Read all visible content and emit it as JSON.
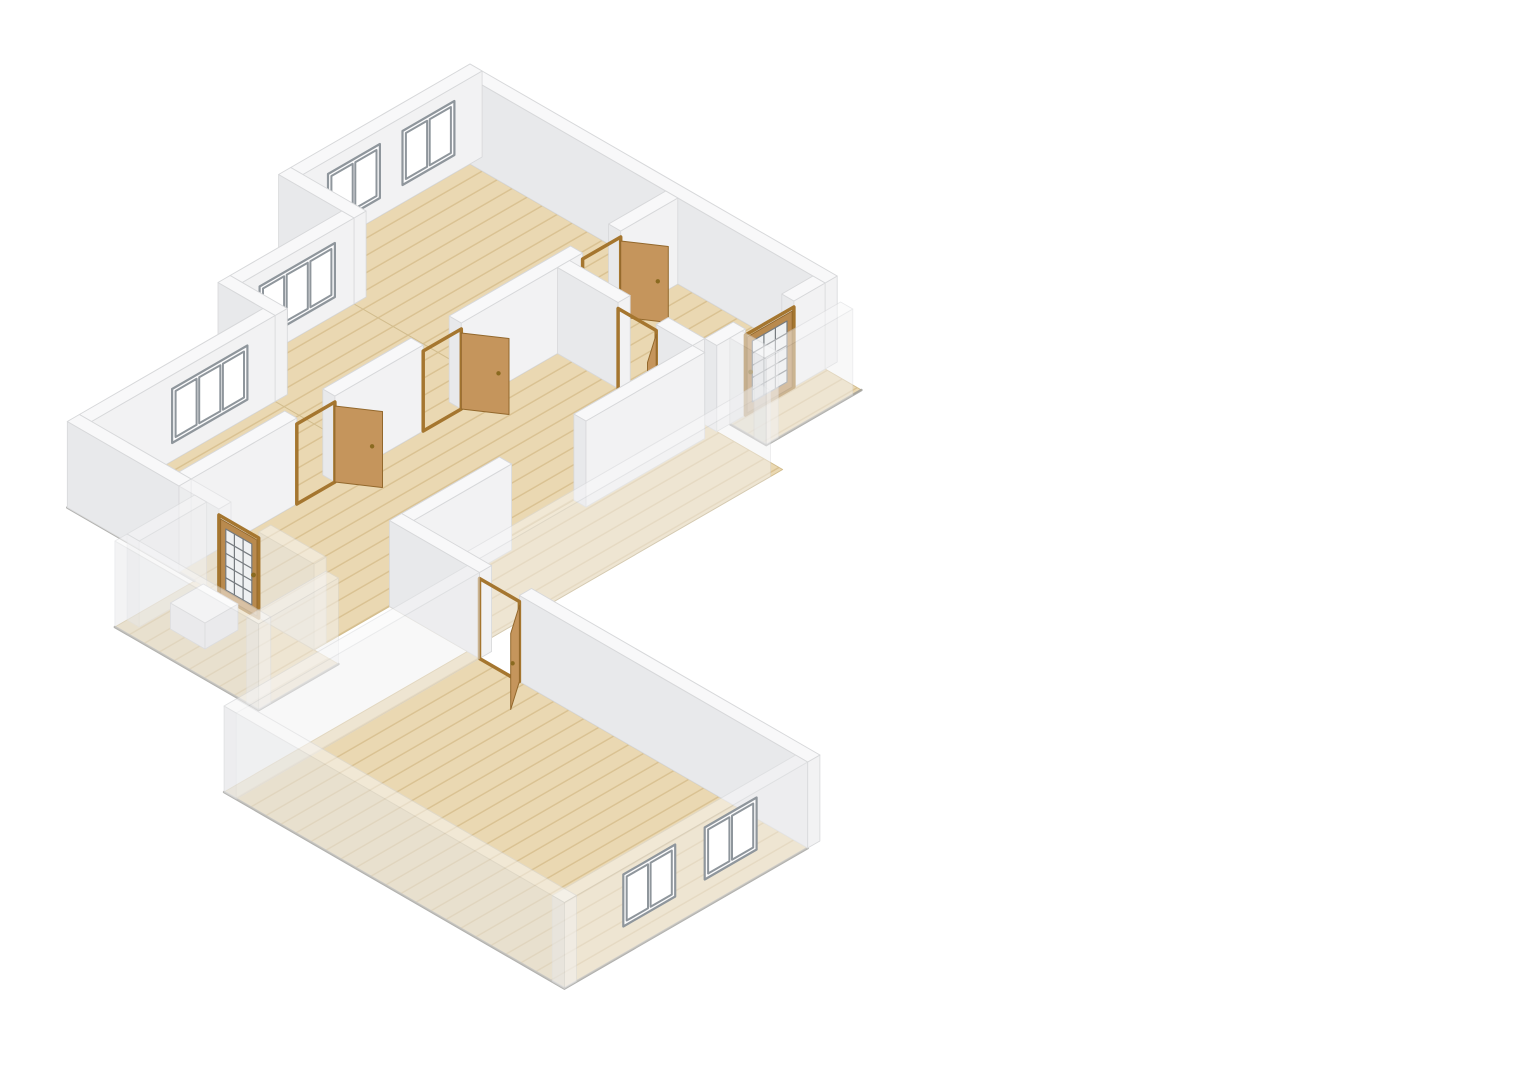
{
  "view": {
    "width": 1529,
    "height": 1080,
    "background": "#ffffff"
  },
  "scene": {
    "iso": {
      "ox": 470,
      "oy": 150,
      "cos": 0.866,
      "sin": 0.5,
      "wallHeight": 86
    },
    "palette": {
      "bg": "#ffffff",
      "wallTop": "#f8f8f9",
      "wallSW": "#e8e9eb",
      "wallSE": "#f2f2f3",
      "wallStroke": "#d7d8da",
      "floorBase": "#ead8b2",
      "floorPlank": "#d9c191",
      "floorStroke": "#d2bd8e",
      "slabEdge": "#9d9d9b",
      "windowFrame": "#fcfcfd",
      "windowBar": "#8f969c",
      "doorFrame": "#a5762f",
      "doorWood": "#c5955c",
      "doorWoodDark": "#93682c",
      "glazedLeaf": "#b98a4e",
      "glass": "#eff1f2",
      "glassBar": "#767b7f",
      "knob": "#8a6a20",
      "fixtureTop": "#ffffff",
      "fixtureSide": "#ededee",
      "fixtureStroke": "#d0d0d2"
    },
    "items": [
      {
        "t": "floor",
        "n": "floor-bedroom-1",
        "r": [
          14,
          14,
          254,
          221
        ]
      },
      {
        "t": "floor",
        "n": "floor-bedroom-2",
        "r": [
          87,
          221,
          254,
          364
        ]
      },
      {
        "t": "floor",
        "n": "floor-bedroom-3",
        "r": [
          139,
          364,
          254,
          590
        ]
      },
      {
        "t": "floor",
        "n": "floor-hallway",
        "r": [
          254,
          14,
          410,
          590
        ]
      },
      {
        "t": "floor",
        "n": "floor-corridor",
        "r": [
          410,
          139,
          500,
          503
        ]
      },
      {
        "t": "floor",
        "n": "floor-rear-porch",
        "r": [
          424,
          14,
          466,
          124
        ]
      },
      {
        "t": "floor",
        "n": "floor-front-porch",
        "r": [
          272,
          590,
          438,
          682
        ]
      },
      {
        "t": "floor",
        "n": "floor-living-room",
        "r": [
          500,
          503,
          893,
          784
        ]
      },
      {
        "t": "edge",
        "n": "slab-edge-left",
        "pts": [
          [
            125,
            590
          ],
          [
            272,
            590
          ]
        ]
      },
      {
        "t": "edge",
        "n": "slab-edge-front-porch",
        "pts": [
          [
            272,
            682
          ],
          [
            438,
            682
          ],
          [
            438,
            590
          ]
        ]
      },
      {
        "t": "edge",
        "n": "slab-edge-rear-porch",
        "pts": [
          [
            424,
            124
          ],
          [
            466,
            124
          ],
          [
            466,
            14
          ]
        ]
      },
      {
        "t": "edge",
        "n": "slab-edge-living-room",
        "pts": [
          [
            500,
            784
          ],
          [
            893,
            784
          ],
          [
            893,
            503
          ]
        ]
      },
      {
        "t": "wall",
        "n": "wall-ne-exterior",
        "r": [
          0,
          0,
          424,
          14
        ]
      },
      {
        "t": "wall",
        "n": "wall-nw-bedroom-1",
        "r": [
          0,
          0,
          14,
          207
        ]
      },
      {
        "t": "win",
        "n": "window-bedroom-1-a",
        "p": "x",
        "c": 14,
        "a": 32,
        "b": 92,
        "z": [
          18,
          72
        ],
        "panes": 2
      },
      {
        "t": "win",
        "n": "window-bedroom-1-b",
        "p": "x",
        "c": 14,
        "a": 118,
        "b": 178,
        "z": [
          18,
          72
        ],
        "panes": 2
      },
      {
        "t": "wall",
        "n": "wall-step-1",
        "r": [
          0,
          207,
          87,
          221
        ]
      },
      {
        "t": "wall",
        "n": "wall-nw-bedroom-2",
        "r": [
          73,
          221,
          87,
          350
        ]
      },
      {
        "t": "win",
        "n": "window-bedroom-2",
        "p": "x",
        "c": 87,
        "a": 243,
        "b": 330,
        "z": [
          18,
          72
        ],
        "panes": 3
      },
      {
        "t": "wall",
        "n": "wall-step-2",
        "r": [
          73,
          350,
          139,
          364
        ]
      },
      {
        "t": "wall",
        "n": "wall-nw-bedroom-3",
        "r": [
          125,
          364,
          139,
          576
        ]
      },
      {
        "t": "win",
        "n": "window-bedroom-3",
        "p": "x",
        "c": 139,
        "a": 396,
        "b": 483,
        "z": [
          18,
          72
        ],
        "panes": 3
      },
      {
        "t": "wall",
        "n": "wall-partition-a",
        "r": [
          240,
          14,
          254,
          80
        ]
      },
      {
        "t": "wall",
        "n": "wall-partition-b",
        "r": [
          240,
          124,
          254,
          264
        ]
      },
      {
        "t": "wall",
        "n": "wall-partition-c",
        "r": [
          240,
          308,
          254,
          410
        ]
      },
      {
        "t": "wall",
        "n": "wall-partition-d",
        "r": [
          240,
          454,
          254,
          576
        ]
      },
      {
        "t": "door",
        "n": "door-bedroom-1",
        "p": "x",
        "c": 254,
        "a": 80,
        "b": 124,
        "leaf": [
          254,
          80,
          287,
          58
        ]
      },
      {
        "t": "door",
        "n": "door-bedroom-2",
        "p": "x",
        "c": 254,
        "a": 264,
        "b": 308,
        "leaf": [
          254,
          264,
          287,
          242
        ]
      },
      {
        "t": "door",
        "n": "door-bedroom-3",
        "p": "x",
        "c": 254,
        "a": 410,
        "b": 454,
        "leaf": [
          254,
          410,
          287,
          388
        ]
      },
      {
        "t": "wall",
        "n": "wall-study-sw-a",
        "r": [
          254,
          139,
          324,
          153
        ]
      },
      {
        "t": "wall",
        "n": "wall-study-sw-b",
        "r": [
          368,
          139,
          410,
          153
        ]
      },
      {
        "t": "door",
        "n": "door-study",
        "p": "y",
        "c": 153,
        "a": 324,
        "b": 368,
        "leaf": [
          368,
          153,
          391,
          186
        ]
      },
      {
        "t": "wall",
        "n": "wall-rear-entry-a",
        "r": [
          410,
          14,
          424,
          50
        ]
      },
      {
        "t": "wall",
        "n": "wall-rear-entry-b",
        "r": [
          410,
          106,
          424,
          139
        ]
      },
      {
        "t": "door",
        "n": "entry-door-rear",
        "p": "x",
        "c": 424,
        "a": 50,
        "b": 106,
        "glazed": true
      },
      {
        "t": "wall",
        "n": "wall-corridor-a",
        "r": [
          410,
          153,
          424,
          290
        ]
      },
      {
        "t": "wall",
        "n": "wall-corridor-b",
        "r": [
          410,
          376,
          424,
          489
        ]
      },
      {
        "t": "wall",
        "n": "wall-corridor-e",
        "r": [
          486,
          153,
          500,
          489
        ],
        "o": 0.5
      },
      {
        "t": "wall",
        "n": "wall-rear-porch-front",
        "r": [
          424,
          110,
          466,
          124
        ],
        "o": 0.5
      },
      {
        "t": "wall",
        "n": "wall-rear-porch-side",
        "r": [
          452,
          24,
          466,
          124
        ],
        "o": 0.5
      },
      {
        "t": "wall",
        "n": "wall-sw-end",
        "r": [
          125,
          576,
          254,
          590
        ]
      },
      {
        "t": "wall",
        "n": "wall-front-a",
        "r": [
          254,
          576,
          300,
          590
        ],
        "o": 0.5
      },
      {
        "t": "wall",
        "n": "wall-front-b",
        "r": [
          346,
          576,
          410,
          590
        ],
        "o": 0.5
      },
      {
        "t": "door",
        "n": "entry-door-front",
        "p": "y",
        "c": 590,
        "a": 300,
        "b": 346,
        "glazed": true
      },
      {
        "t": "wall",
        "n": "wall-front-porch-left",
        "r": [
          272,
          590,
          286,
          668
        ],
        "o": 0.5
      },
      {
        "t": "box",
        "n": "porch-fixture",
        "r": [
          306,
          614,
          346,
          652
        ],
        "h": 26
      },
      {
        "t": "wall",
        "n": "wall-front-porch-right",
        "r": [
          424,
          590,
          438,
          682
        ],
        "o": 0.5
      },
      {
        "t": "wall",
        "n": "wall-front-porch-front",
        "r": [
          272,
          668,
          438,
          682
        ],
        "o": 0.5
      },
      {
        "t": "wall",
        "n": "wall-living-nw-a",
        "r": [
          410,
          489,
          514,
          503
        ]
      },
      {
        "t": "wall",
        "n": "wall-living-nw-b",
        "r": [
          560,
          489,
          893,
          503
        ]
      },
      {
        "t": "door",
        "n": "door-living-room",
        "p": "y",
        "c": 503,
        "a": 514,
        "b": 560,
        "leaf": [
          560,
          503,
          583,
          536
        ]
      },
      {
        "t": "wall",
        "n": "wall-living-w",
        "r": [
          500,
          503,
          514,
          784
        ],
        "o": 0.5
      },
      {
        "t": "wall",
        "n": "wall-living-se",
        "r": [
          879,
          503,
          893,
          784
        ],
        "o": 0.5
      },
      {
        "t": "win",
        "n": "window-living-1",
        "p": "x",
        "c": 879,
        "a": 548,
        "b": 608,
        "z": [
          14,
          66
        ],
        "panes": 2
      },
      {
        "t": "win",
        "n": "window-living-2",
        "p": "x",
        "c": 879,
        "a": 642,
        "b": 702,
        "z": [
          14,
          66
        ],
        "panes": 2
      },
      {
        "t": "wall",
        "n": "wall-living-sw",
        "r": [
          500,
          770,
          893,
          784
        ],
        "o": 0.5
      }
    ]
  }
}
